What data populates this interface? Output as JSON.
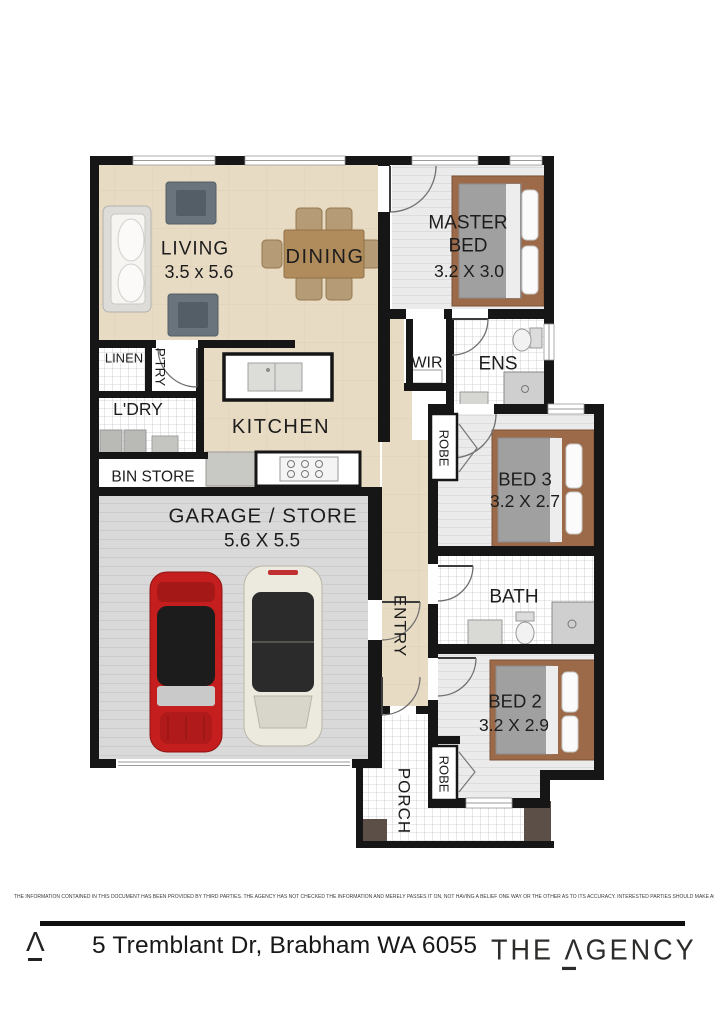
{
  "plan": {
    "rooms": {
      "living": {
        "label": "LIVING",
        "dims": "3.5 x 5.6"
      },
      "dining": {
        "label": "DINING"
      },
      "kitchen": {
        "label": "KITCHEN"
      },
      "master_bed": {
        "line1": "MASTER",
        "line2": "BED",
        "dims": "3.2 X 3.0"
      },
      "wir": {
        "label": "WIR"
      },
      "ens": {
        "label": "ENS"
      },
      "linen": {
        "label": "LINEN"
      },
      "pantry": {
        "label": "P'TRY"
      },
      "laundry": {
        "label": "L'DRY"
      },
      "bin_store": {
        "label": "BIN STORE"
      },
      "garage": {
        "label": "GARAGE / STORE",
        "dims": "5.6 X 5.5"
      },
      "entry": {
        "label": "ENTRY"
      },
      "porch": {
        "label": "PORCH"
      },
      "robe_bed3": {
        "label": "ROBE"
      },
      "bed3": {
        "label": "BED 3",
        "dims": "3.2 X 2.7"
      },
      "bath": {
        "label": "BATH"
      },
      "bed2": {
        "label": "BED 2",
        "dims": "3.2 X 2.9"
      },
      "robe_bed2": {
        "label": "ROBE"
      }
    }
  },
  "footer": {
    "disclaimer": "THE INFORMATION CONTAINED IN THIS DOCUMENT HAS BEEN PROVIDED BY THIRD PARTIES. THE AGENCY HAS NOT CHECKED THE INFORMATION AND MERELY PASSES IT ON, NOT HAVING A BELIEF ONE WAY OR THE OTHER AS TO ITS ACCURACY. INTERESTED PARTIES SHOULD MAKE AND RELY UPON THEIR OWN ENQUIRIES.",
    "address": "5 Tremblant Dr, Brabham WA 6055",
    "brand": {
      "mark": "Λ",
      "word_the": "THE ",
      "word_a": "Λ",
      "word_rest": "GENCY"
    }
  },
  "colors": {
    "wall": "#161616",
    "floor_beige": "#e8dbc4",
    "floor_boards": "#ebebeb",
    "floor_garage": "#d9d9d9",
    "bed_frame": "#9c6a49",
    "bed_blanket": "#a0a0a0",
    "car_red": "#c41e1e",
    "car_white": "#eceade",
    "pillar_brown": "#5c4f47",
    "chair_gray": "#6a747d",
    "dining_wood": "#b08b5c"
  }
}
